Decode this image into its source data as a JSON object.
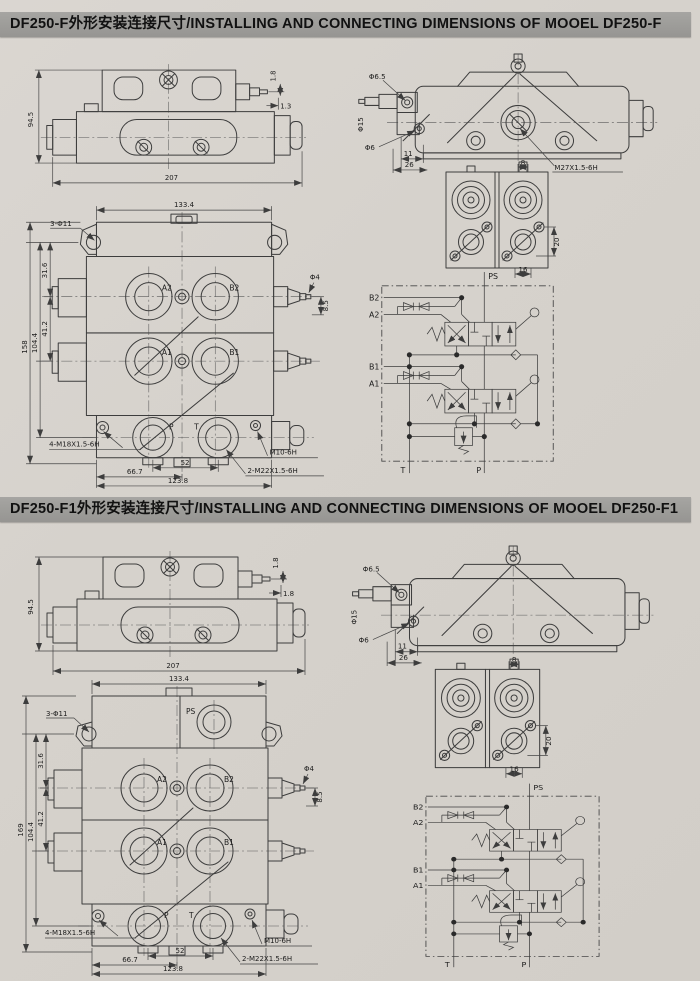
{
  "header_f": {
    "title": "DF250-F外形安装连接尺寸/INSTALLING AND CONNECTING DIMENSIONS OF MOOEL DF250-F"
  },
  "header_f1": {
    "title": "DF250-F1外形安装连接尺寸/INSTALLING AND CONNECTING DIMENSIONS OF MOOEL DF250-F1"
  },
  "f": {
    "side_view": {
      "height": "94.5",
      "length": "207",
      "tip_dia": "1.8",
      "tip_len": "1.3"
    },
    "rear_view": {
      "hole_top": "Φ6.5",
      "hole_side": "Φ15",
      "hole_bottom": "Φ6",
      "dim_11": "11",
      "dim_26": "26",
      "thread": "M27X1.5-6H"
    },
    "port_view": {
      "dim_8": "8",
      "dim_20": "20",
      "dim_16": "16"
    },
    "front_view": {
      "width": "133.4",
      "mount_holes": "3-Φ11",
      "port_a2": "A2",
      "port_b2": "B2",
      "port_a1": "A1",
      "port_b1": "B1",
      "port_p": "P",
      "port_t": "T",
      "height_total": "158",
      "height_mid": "104.4",
      "row_gap": "41.2",
      "top_gap": "31.6",
      "tip_dia": "Φ4",
      "tip_len": "8.5",
      "thread_mount": "4-M18X1.5-6H",
      "thread_gauge": "M10-6H",
      "thread_pt": "2-M22X1.5-6H",
      "dim_52": "52",
      "dim_667": "66.7",
      "dim_1238": "123.8"
    },
    "schematic": {
      "ps": "PS",
      "b2": "B2",
      "a2": "A2",
      "b1": "B1",
      "a1": "A1",
      "t": "T",
      "p": "P"
    }
  },
  "f1": {
    "side_view": {
      "height": "94.5",
      "length": "207",
      "tip_dia": "1.8",
      "tip_len": "1.8"
    },
    "rear_view": {
      "hole_top": "Φ6.5",
      "hole_side": "Φ15",
      "hole_bottom": "Φ6",
      "dim_11": "11",
      "dim_26": "26"
    },
    "port_view": {
      "dim_8": "8",
      "dim_20": "20",
      "dim_16": "16"
    },
    "front_view": {
      "width": "133.4",
      "mount_holes": "3-Φ11",
      "port_ps": "PS",
      "port_a2": "A2",
      "port_b2": "B2",
      "port_a1": "A1",
      "port_b1": "B1",
      "port_p": "P",
      "port_t": "T",
      "height_total": "169",
      "height_mid": "104.4",
      "row_gap": "41.2",
      "top_gap": "31.6",
      "tip_dia": "Φ4",
      "tip_len": "8.5",
      "thread_mount": "4-M18X1.5-6H",
      "thread_gauge": "M10-6H",
      "thread_pt": "2-M22X1.5-6H",
      "dim_52": "52",
      "dim_667": "66.7",
      "dim_1238": "123.8"
    },
    "schematic": {
      "ps": "PS",
      "b2": "B2",
      "a2": "A2",
      "b1": "B1",
      "a1": "A1",
      "t": "T",
      "p": "P"
    }
  }
}
